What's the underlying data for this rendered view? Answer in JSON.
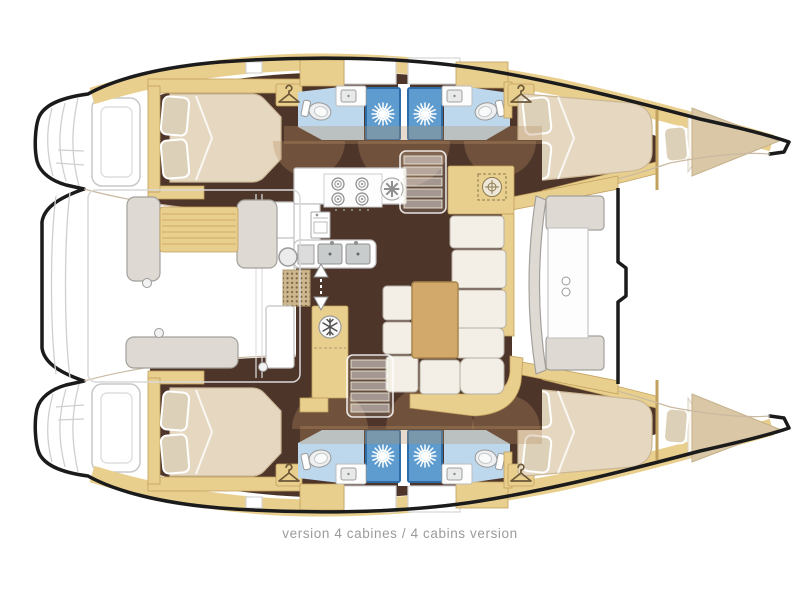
{
  "caption": {
    "text": "version 4 cabines / 4 cabins version"
  },
  "colors": {
    "outline": "#1b1b1b",
    "deck_line": "#cfcfcf",
    "wood": "#e9cf8e",
    "wood_dark": "#c2a05e",
    "floor_brown": "#4e352a",
    "arc_tan": "#b98f63",
    "mattress": "#e6d8c0",
    "mattress_edge": "#cbb796",
    "pillow": "#ddd0b9",
    "bath_blue": "#bdd7ec",
    "shower_blue": "#5e9ccf",
    "shower_border": "#2e6ca8",
    "counter_stroke": "#c2c2c2",
    "cushion": "#f3efe6",
    "cushion_stroke": "#b5b0a4",
    "gray_seat": "#ded9d3",
    "gray_seat_stroke": "#a3a09b",
    "table_wood": "#d2a96a",
    "beige_deck": "#d9c7a6",
    "caption_gray": "#9b9b9b"
  },
  "icons": {
    "wardrobe": "hanger-icon",
    "shower": "sun-shower-icon",
    "refrigerator": "snowflake-icon",
    "stove": "four-burner-stove-icon",
    "extractor": "fan-icon",
    "companionway": "stairs-icon",
    "entry_door": "double-arrow-icon"
  }
}
